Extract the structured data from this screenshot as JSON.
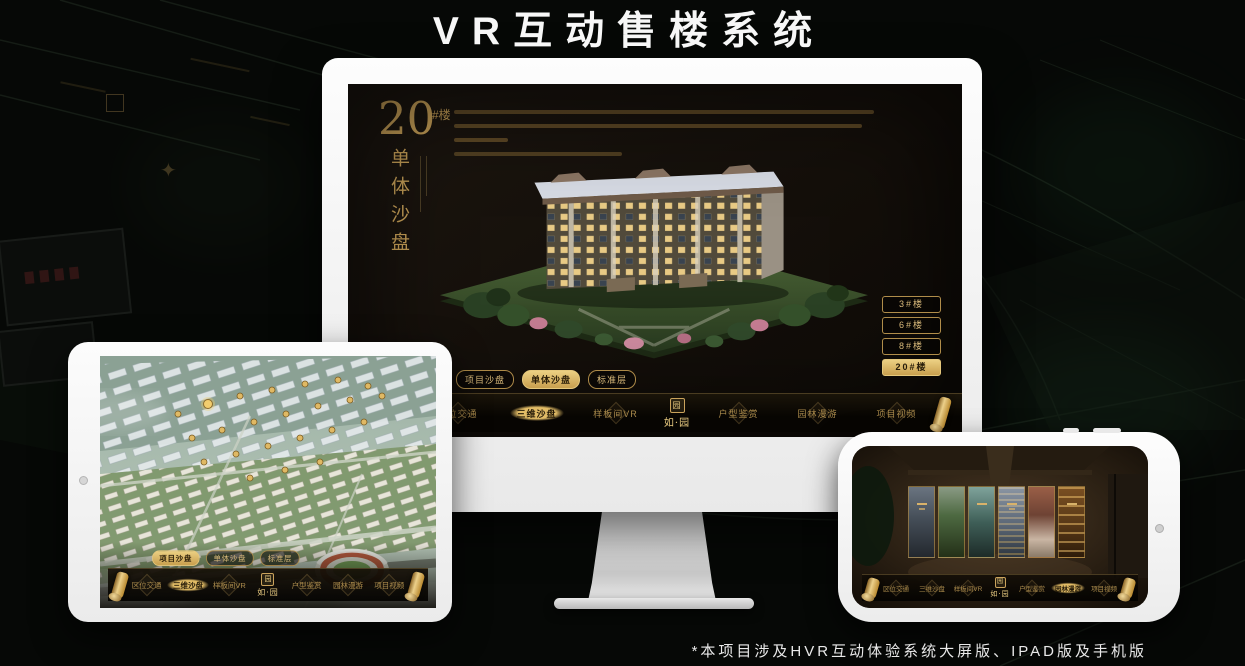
{
  "page": {
    "title": "VR互动售楼系统",
    "footnote": "*本项目涉及HVR互动体验系统大屏版、IPAD版及手机版"
  },
  "colors": {
    "gold": "#C9A35C",
    "gold_active": "#D9B261",
    "screen_bg": "#140F0A",
    "device_frame": "#F4F4F4"
  },
  "brand": {
    "seal_char": "园",
    "name": "如·园"
  },
  "desktop": {
    "heading": {
      "number": "20",
      "suffix": "#楼",
      "subtitle": "单体沙盘"
    },
    "floor_buttons": [
      {
        "label": "3#楼",
        "active": false
      },
      {
        "label": "6#楼",
        "active": false
      },
      {
        "label": "8#楼",
        "active": false
      },
      {
        "label": "20#楼",
        "active": true
      }
    ],
    "tabs": [
      {
        "label": "项目沙盘",
        "active": false
      },
      {
        "label": "单体沙盘",
        "active": true
      },
      {
        "label": "标准层",
        "active": false
      }
    ],
    "nav_items": [
      "区位交通",
      "三维沙盘",
      "样板间VR",
      "户型鉴赏",
      "园林漫游",
      "项目视频"
    ],
    "nav_active": "三维沙盘"
  },
  "tablet": {
    "tabs": [
      {
        "label": "项目沙盘",
        "active": true
      },
      {
        "label": "单体沙盘",
        "active": false
      },
      {
        "label": "标准层",
        "active": false
      }
    ],
    "nav_items": [
      "区位交通",
      "三维沙盘",
      "样板间VR",
      "户型鉴赏",
      "园林漫游",
      "项目视频"
    ],
    "nav_active": "三维沙盘"
  },
  "phone": {
    "nav_items": [
      "区位交通",
      "三维沙盘",
      "样板间VR",
      "户型鉴赏",
      "园林漫游",
      "项目视频"
    ],
    "nav_active": "园林漫游"
  }
}
